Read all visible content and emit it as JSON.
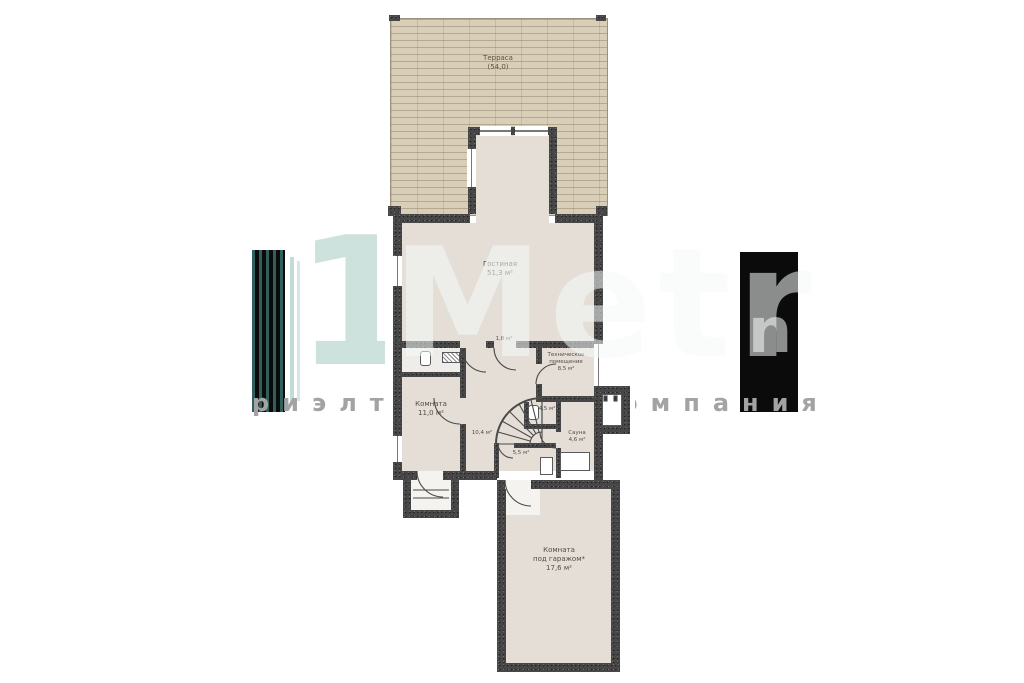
{
  "watermark": {
    "digit": "1",
    "brand_word": "Metr",
    "brand_tail": "n",
    "tagline": "риэлторская компания",
    "colors": {
      "teal_digit": "#cde2dd",
      "black_block": "#0b0b0b",
      "bar_teal": "#2f605b",
      "letter_gray": "#a3a3a3"
    }
  },
  "plan": {
    "colors": {
      "wall": "#474747",
      "interior": "#e4ded7",
      "terrace": "#d9cfb8"
    },
    "rooms": {
      "terrace": {
        "lines": [
          "Терраса",
          "(54,0)"
        ]
      },
      "living": {
        "lines": [
          "Гостиная",
          "51,3 м²"
        ]
      },
      "closet": {
        "lines": [
          "1,8 м²"
        ]
      },
      "tech": {
        "lines": [
          "Техническое",
          "помещение",
          "8,5 м²"
        ]
      },
      "room": {
        "lines": [
          "Комната",
          "11,0 м²"
        ]
      },
      "hall": {
        "lines": [
          "10,4 м²"
        ]
      },
      "wc": {
        "lines": [
          "4,5 м²"
        ]
      },
      "sauna": {
        "lines": [
          "Сауна",
          "4,6 м²"
        ]
      },
      "shower": {
        "lines": [
          "5,5 м²"
        ]
      },
      "garage": {
        "lines": [
          "Комната",
          "под гаражом*",
          "17,6 м²"
        ]
      }
    },
    "icons": {
      "winder_stairs": "winder-stairs-icon (svg fan)",
      "toilet": "toilet-icon (rounded rect)",
      "radiator": "radiator-icon (hatched rect)",
      "sauna_bench": "sauna-bench-icon (outlined rect)",
      "shower_tray": "shower-tray-icon (outlined rect)",
      "door_swing": "door-swing-arc (quarter circle)"
    }
  }
}
